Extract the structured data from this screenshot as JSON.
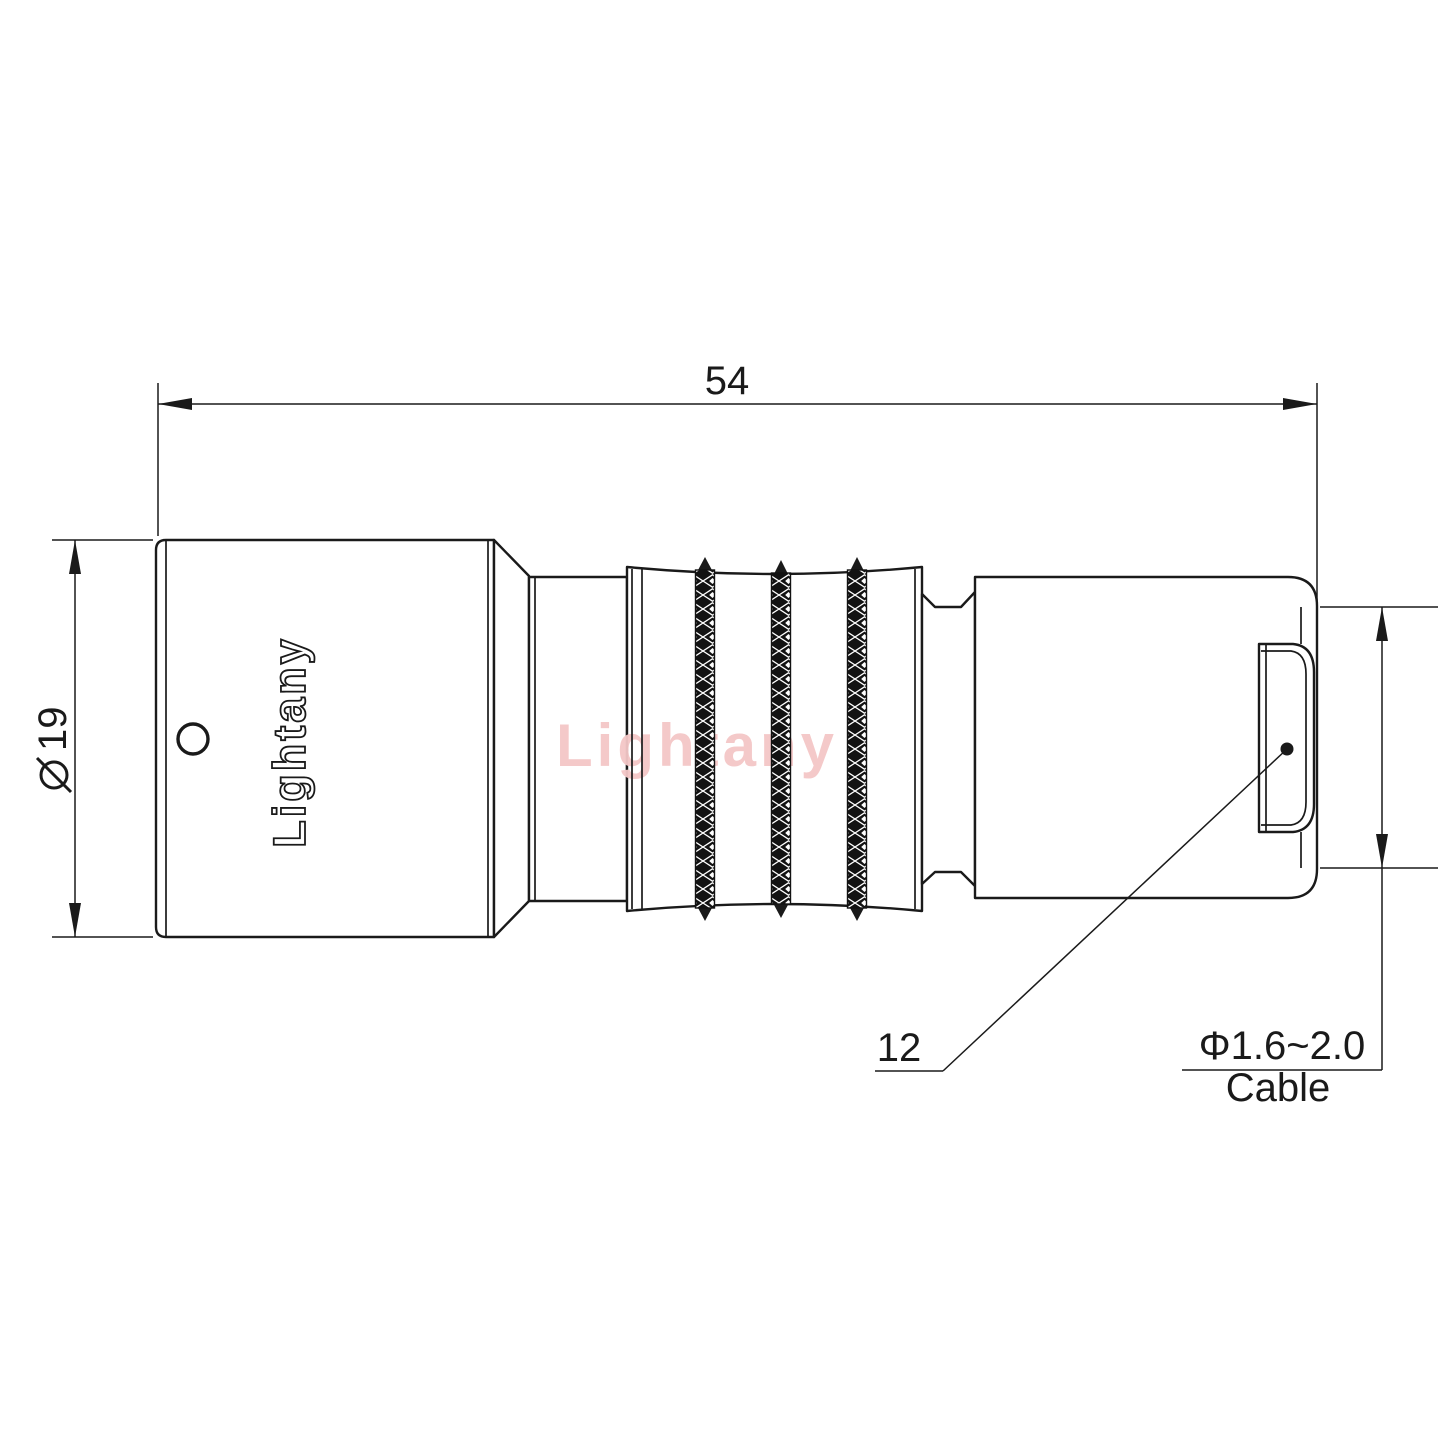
{
  "drawing": {
    "watermark_text": "Lightany",
    "engraving_text": "Lightany",
    "dimensions": {
      "overall_length": {
        "label": "54"
      },
      "front_diameter": {
        "label": "⌀19",
        "symbol": "diameter-sign",
        "digits": "19"
      },
      "rear_diameter": {
        "label": "12"
      },
      "cable": {
        "spec": "Φ1.6~2.0",
        "caption": "Cable"
      }
    },
    "colors": {
      "line": "#1a1a1a",
      "watermark": "#f4c7c7",
      "background": "#ffffff"
    }
  }
}
